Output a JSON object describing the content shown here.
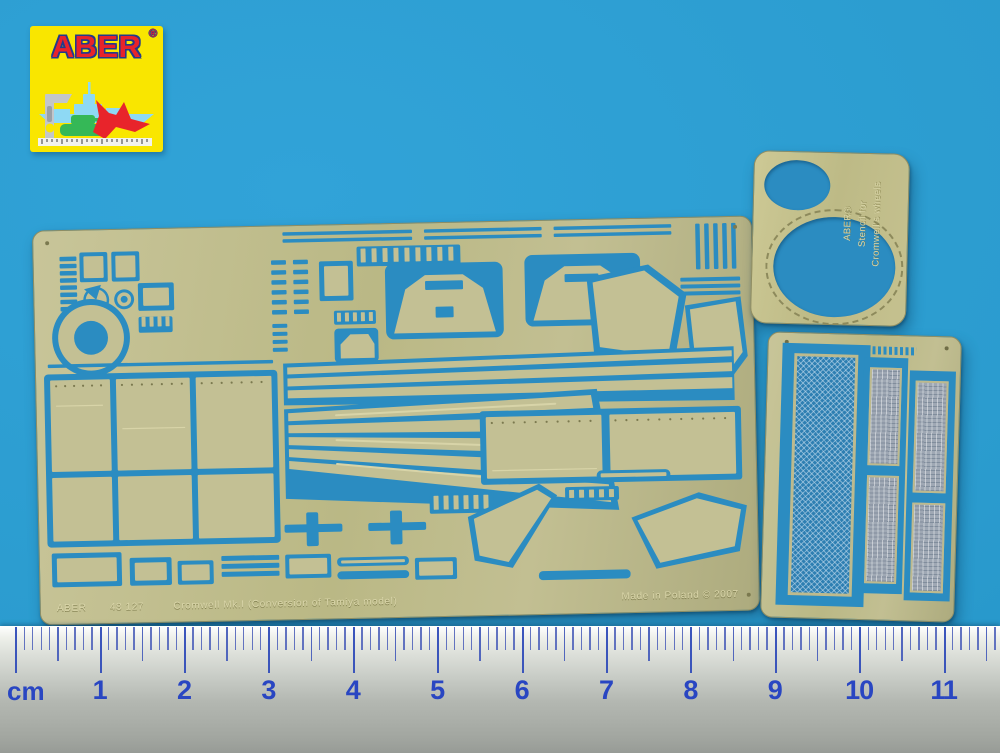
{
  "photo": {
    "logo": {
      "brand": "ABER",
      "registered": "®"
    },
    "main_fret": {
      "bottom_left_brand": "ABER",
      "bottom_left_code": "48 127",
      "bottom_left_title": "Cromwell Mk.I  (Conversion of Tamiya model)",
      "bottom_right_text": "Made in Poland ©  2007"
    },
    "stencil": {
      "line1": "ABER®",
      "line2": "Stencil for",
      "line3": "Cromwell's wheels"
    },
    "ruler": {
      "unit_label": "cm",
      "numbers": [
        "1",
        "2",
        "3",
        "4",
        "5",
        "6",
        "7",
        "8",
        "9",
        "10",
        "11"
      ]
    },
    "colors": {
      "background_blue": "#2B9CD4",
      "brass": "#BCBA8C",
      "cutout_blue": "#2B8CC1",
      "ruler_digit_blue": "#2946C2",
      "logo_yellow": "#F9E600",
      "logo_red": "#E8232A"
    }
  }
}
